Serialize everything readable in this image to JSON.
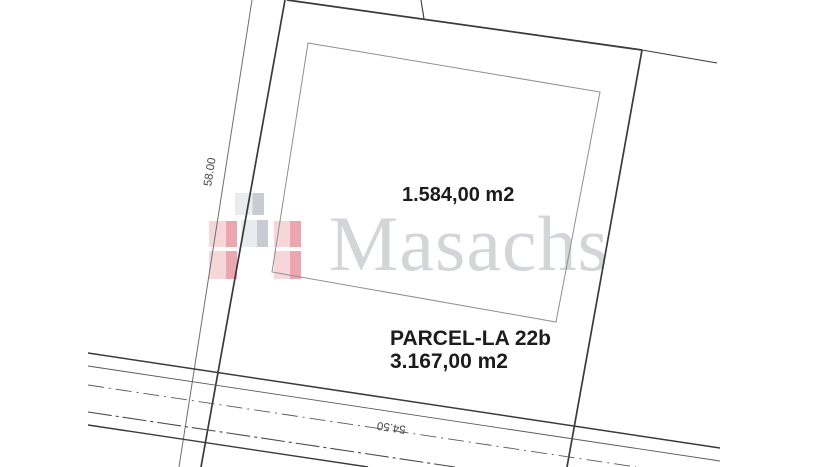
{
  "labels": {
    "building_area": "1.584,00 m2",
    "parcel_name": "PARCEL-LA 22b",
    "parcel_area": "3.167,00 m2",
    "dimension_left": "58.00",
    "dimension_bottom": "54.50"
  },
  "watermark": {
    "brand": "Masachs",
    "logo_colors": {
      "red_light": "#f6d6d9",
      "red_dark": "#eaa7af",
      "gray_light": "#e9ebee",
      "gray_dark": "#c8ccd2"
    },
    "text_color": "#d3d5d9"
  },
  "drawing": {
    "boundary_line_color": "#3a3a3a",
    "building_outline_color": "#8f8f8f",
    "background_color": "#ffffff"
  }
}
